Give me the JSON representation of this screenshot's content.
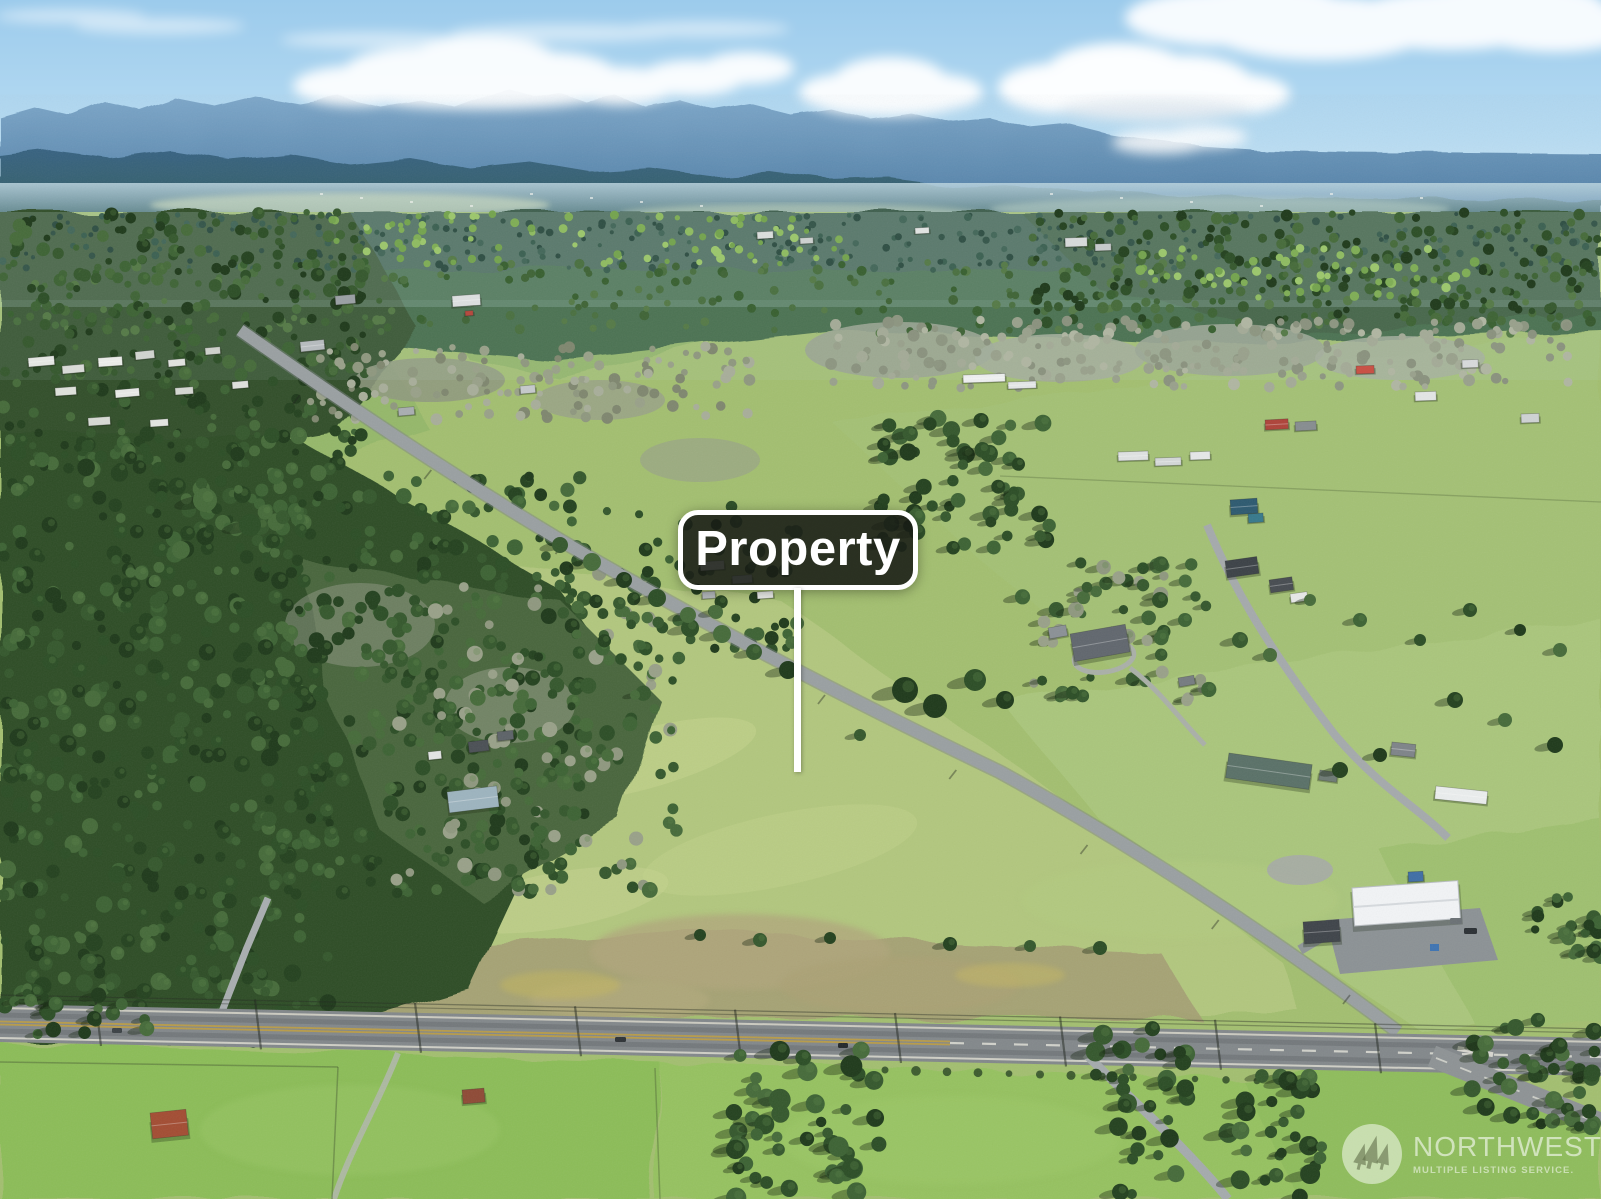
{
  "annotation": {
    "label": "Property"
  },
  "watermark": {
    "brand": "NORTHWEST",
    "tagline": "MULTIPLE LISTING SERVICE."
  },
  "icons": {
    "watermark_logo": "trees-icon"
  },
  "colors": {
    "sign_background": "#181b16",
    "sign_border": "#ffffff",
    "sign_text": "#ffffff",
    "watermark_text": "#ffffff",
    "sky_blue": "#a5d3ef",
    "mountain_blue": "#45749c",
    "forest_green": "#2e4d28",
    "field_green": "#a3bf70",
    "road_gray": "#84898c"
  }
}
